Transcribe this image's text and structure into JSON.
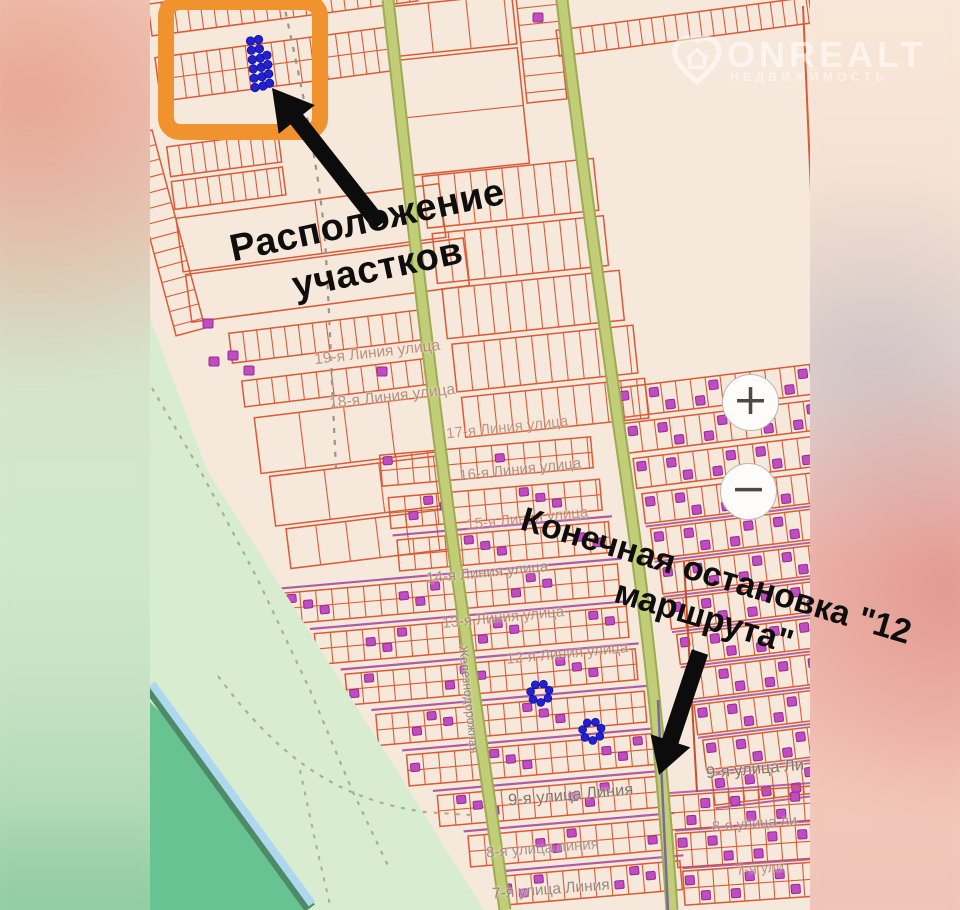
{
  "page": {
    "type": "real-estate-map-screenshot"
  },
  "logo": {
    "brand": "ONREALT",
    "tagline": "НЕДВИЖИМОСТЬ"
  },
  "annotations": {
    "plots_location": {
      "line1": "Расположение",
      "line2": "участков"
    },
    "bus_stop": {
      "line1": "Конечная остановка \"12",
      "line2": "маршрута\""
    }
  },
  "zoom_controls": {
    "zoom_in": "+",
    "zoom_out": "−"
  },
  "street_labels": [
    {
      "id": "line19",
      "text": "19-я Линия улица"
    },
    {
      "id": "line18",
      "text": "18-я Линия улица"
    },
    {
      "id": "line17",
      "text": "17-я Линия улица"
    },
    {
      "id": "line16",
      "text": "16-я Линия улица"
    },
    {
      "id": "line15",
      "text": "15-я Линия улица"
    },
    {
      "id": "line14",
      "text": "14-я Линия улица"
    },
    {
      "id": "line13",
      "text": "13-я Линия улица"
    },
    {
      "id": "line12",
      "text": "12-я Линия улица"
    },
    {
      "id": "street9",
      "text": "9-я улица Линия"
    },
    {
      "id": "street9r",
      "text": "9-я улица Ли"
    },
    {
      "id": "street8",
      "text": "8-я улица линия"
    },
    {
      "id": "street7",
      "text": "7-я улица Линия"
    },
    {
      "id": "street8r",
      "text": "8-я улица ли"
    },
    {
      "id": "street7r",
      "text": "7-я ули"
    },
    {
      "id": "vstreet",
      "text": "Железнодорожная"
    }
  ],
  "map_markers": {
    "highlighted_cluster_dots": 16,
    "mid_cluster_dots": 7,
    "lower_cluster_dots": 7
  },
  "theme": {
    "map_bg": "#f7e8dc",
    "parcel_line": "#d95b35",
    "parcel_line_dark": "#c44f2f",
    "building_purple": "#c24ac2",
    "building_purple_dark": "#8e2f8e",
    "street_purple": "#a0459a",
    "road_green": "#c2cd78",
    "road_green_edge": "#9dab52",
    "area_green": "#d8ecd0",
    "forest_green": "#68c393",
    "water_blue": "#aed7f0",
    "water_edge": "#4e8a66",
    "path_olive": "#a9b189",
    "path_gray": "#9a948e",
    "accent_orange": "#f0922e",
    "marker_blue": "#2121d3",
    "annotation_black": "#0e0e0e"
  }
}
